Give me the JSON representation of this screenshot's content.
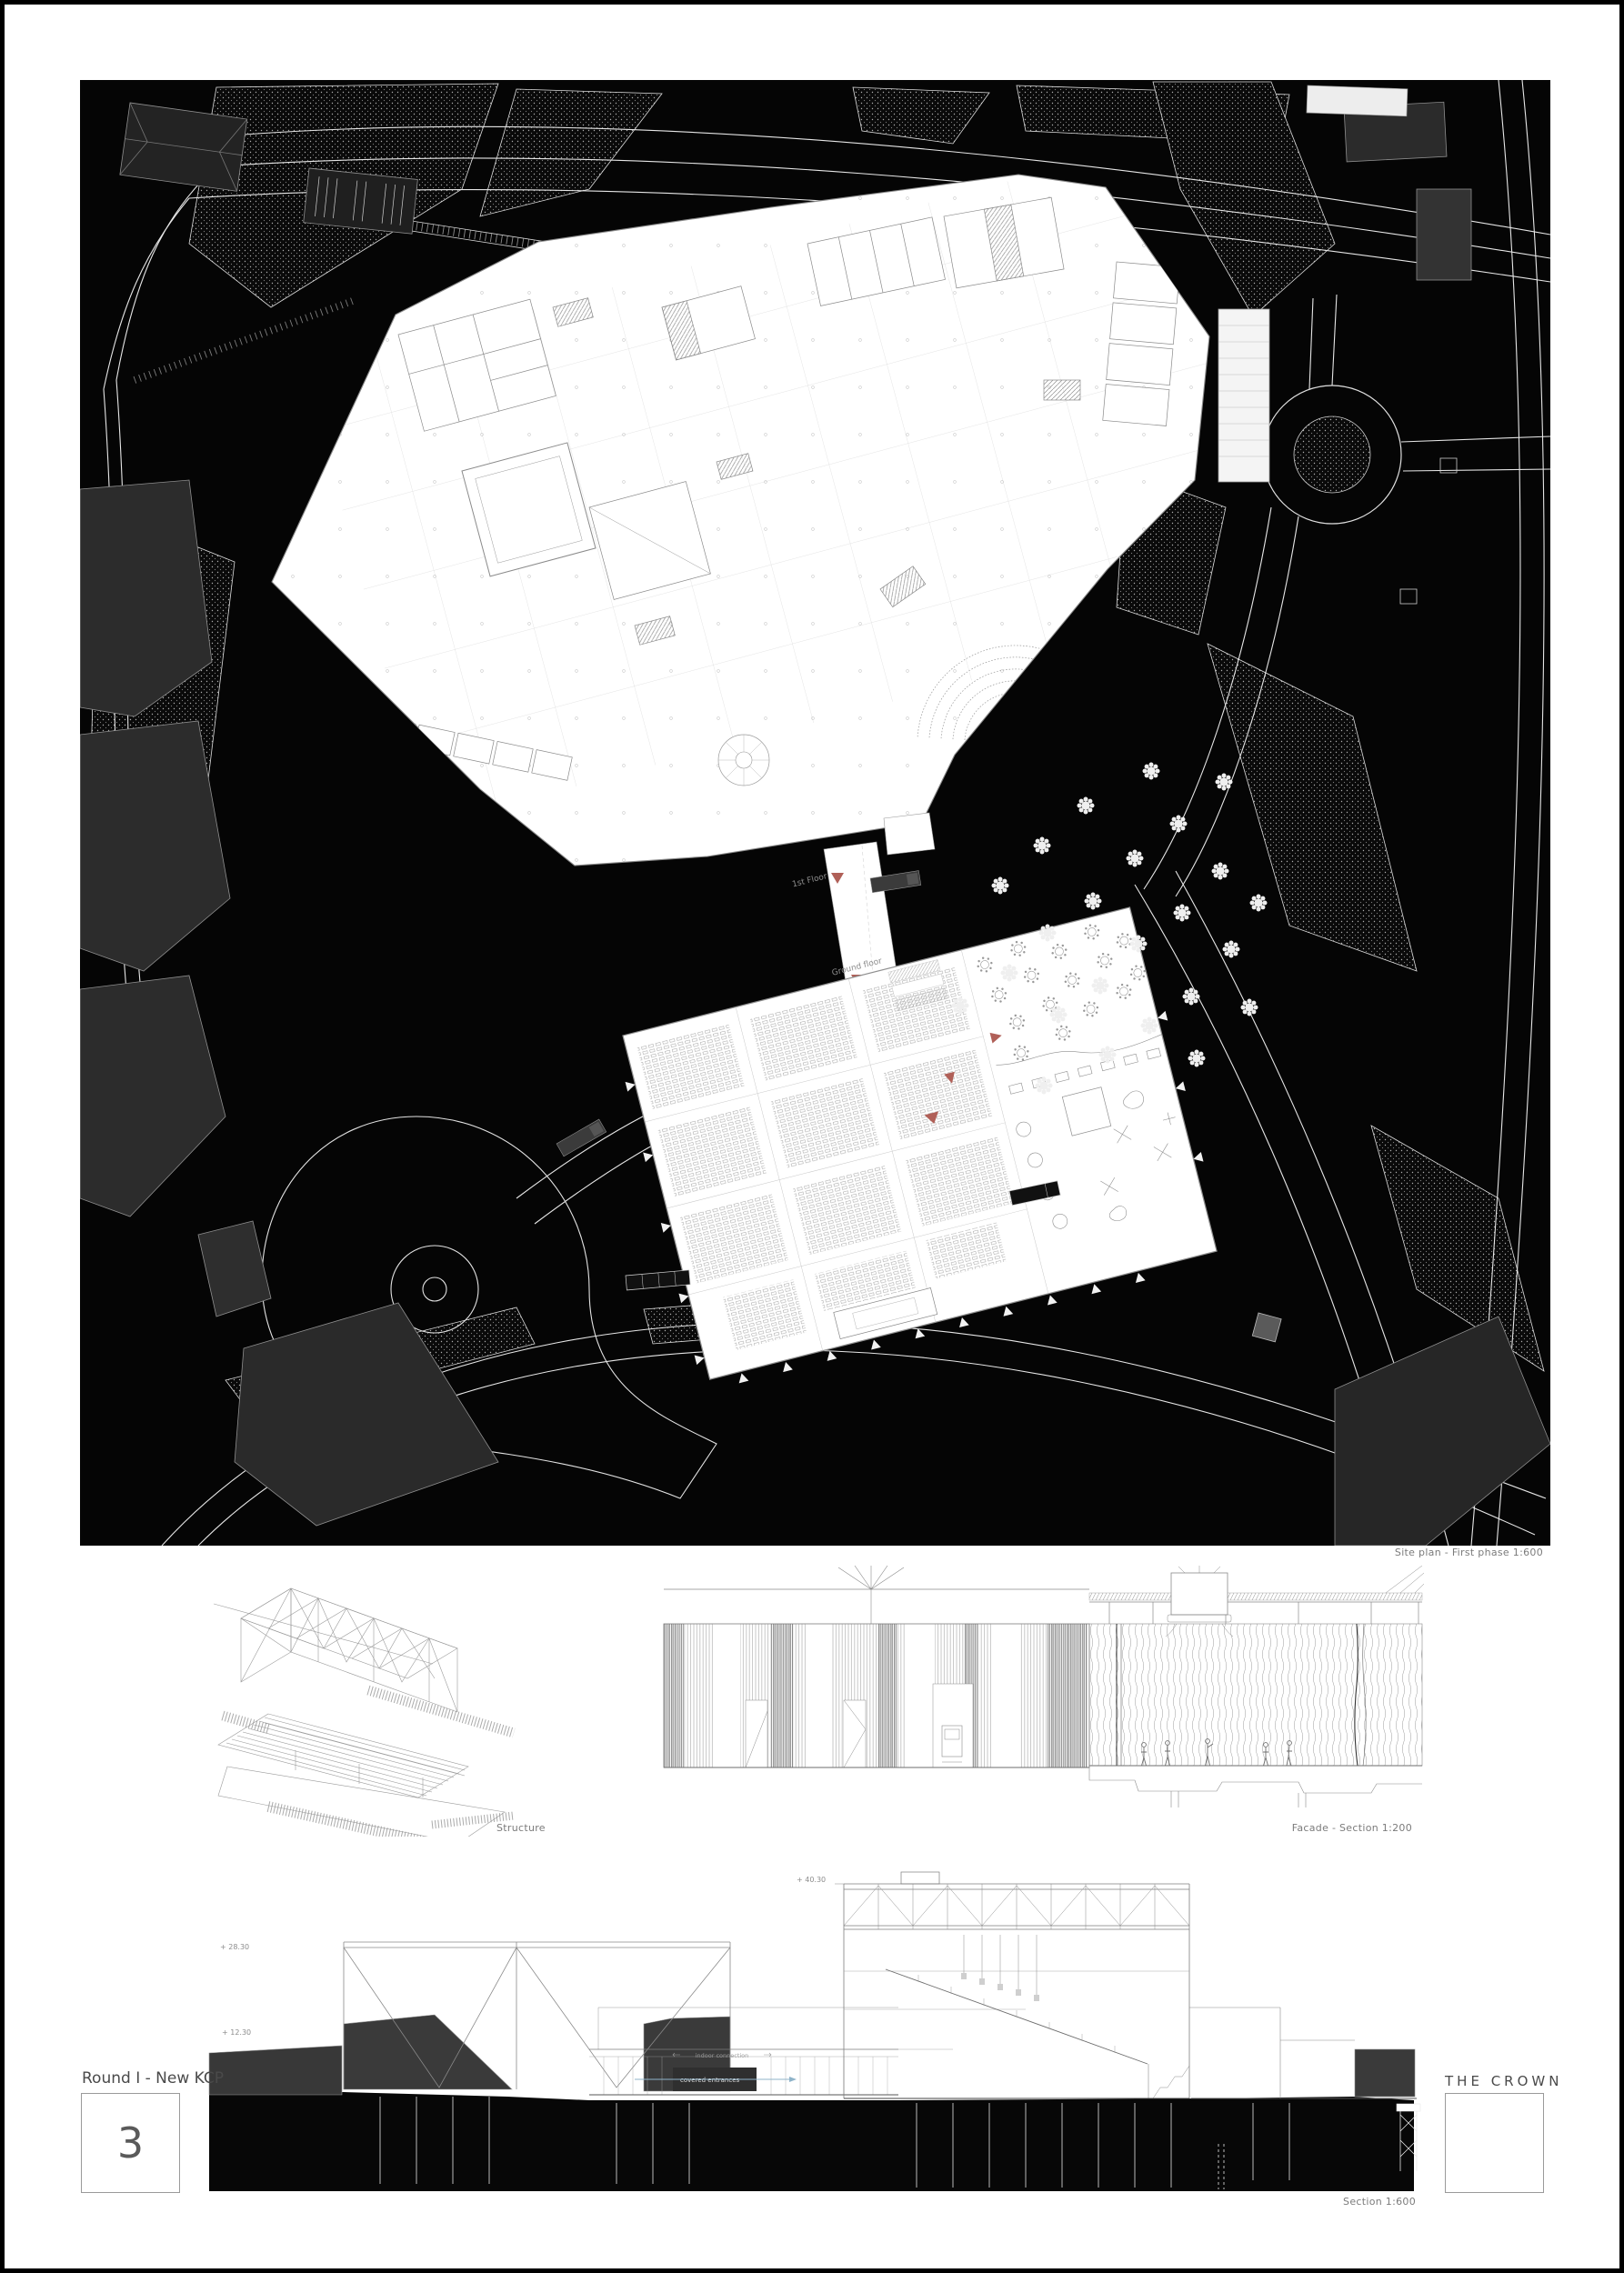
{
  "board": {
    "project_label": "Round I - New KCP",
    "sheet_number": "3",
    "project_title": "THE CROWN"
  },
  "captions": {
    "site_plan": "Site plan - First phase 1:600",
    "structure": "Structure",
    "facade": "Facade - Section 1:200",
    "section": "Section 1:600"
  },
  "site_plan": {
    "annotations": {
      "first_floor": "1st Floor",
      "ground_floor": "Ground floor"
    }
  },
  "section": {
    "levels": {
      "top": "+ 40.30",
      "mid": "+ 28.30",
      "low": "+ 12.30"
    },
    "annotations": {
      "indoor_connection": "indoor connection",
      "covered_entrances": "covered entrances"
    }
  },
  "colors": {
    "sheet_background": "#ffffff",
    "plan_background": "#050505",
    "drawing_gray": "#8a8a8a",
    "block_gray": "#2e2e2e",
    "accent_red": "#b06058",
    "accent_blue": "#8fb3c9"
  }
}
